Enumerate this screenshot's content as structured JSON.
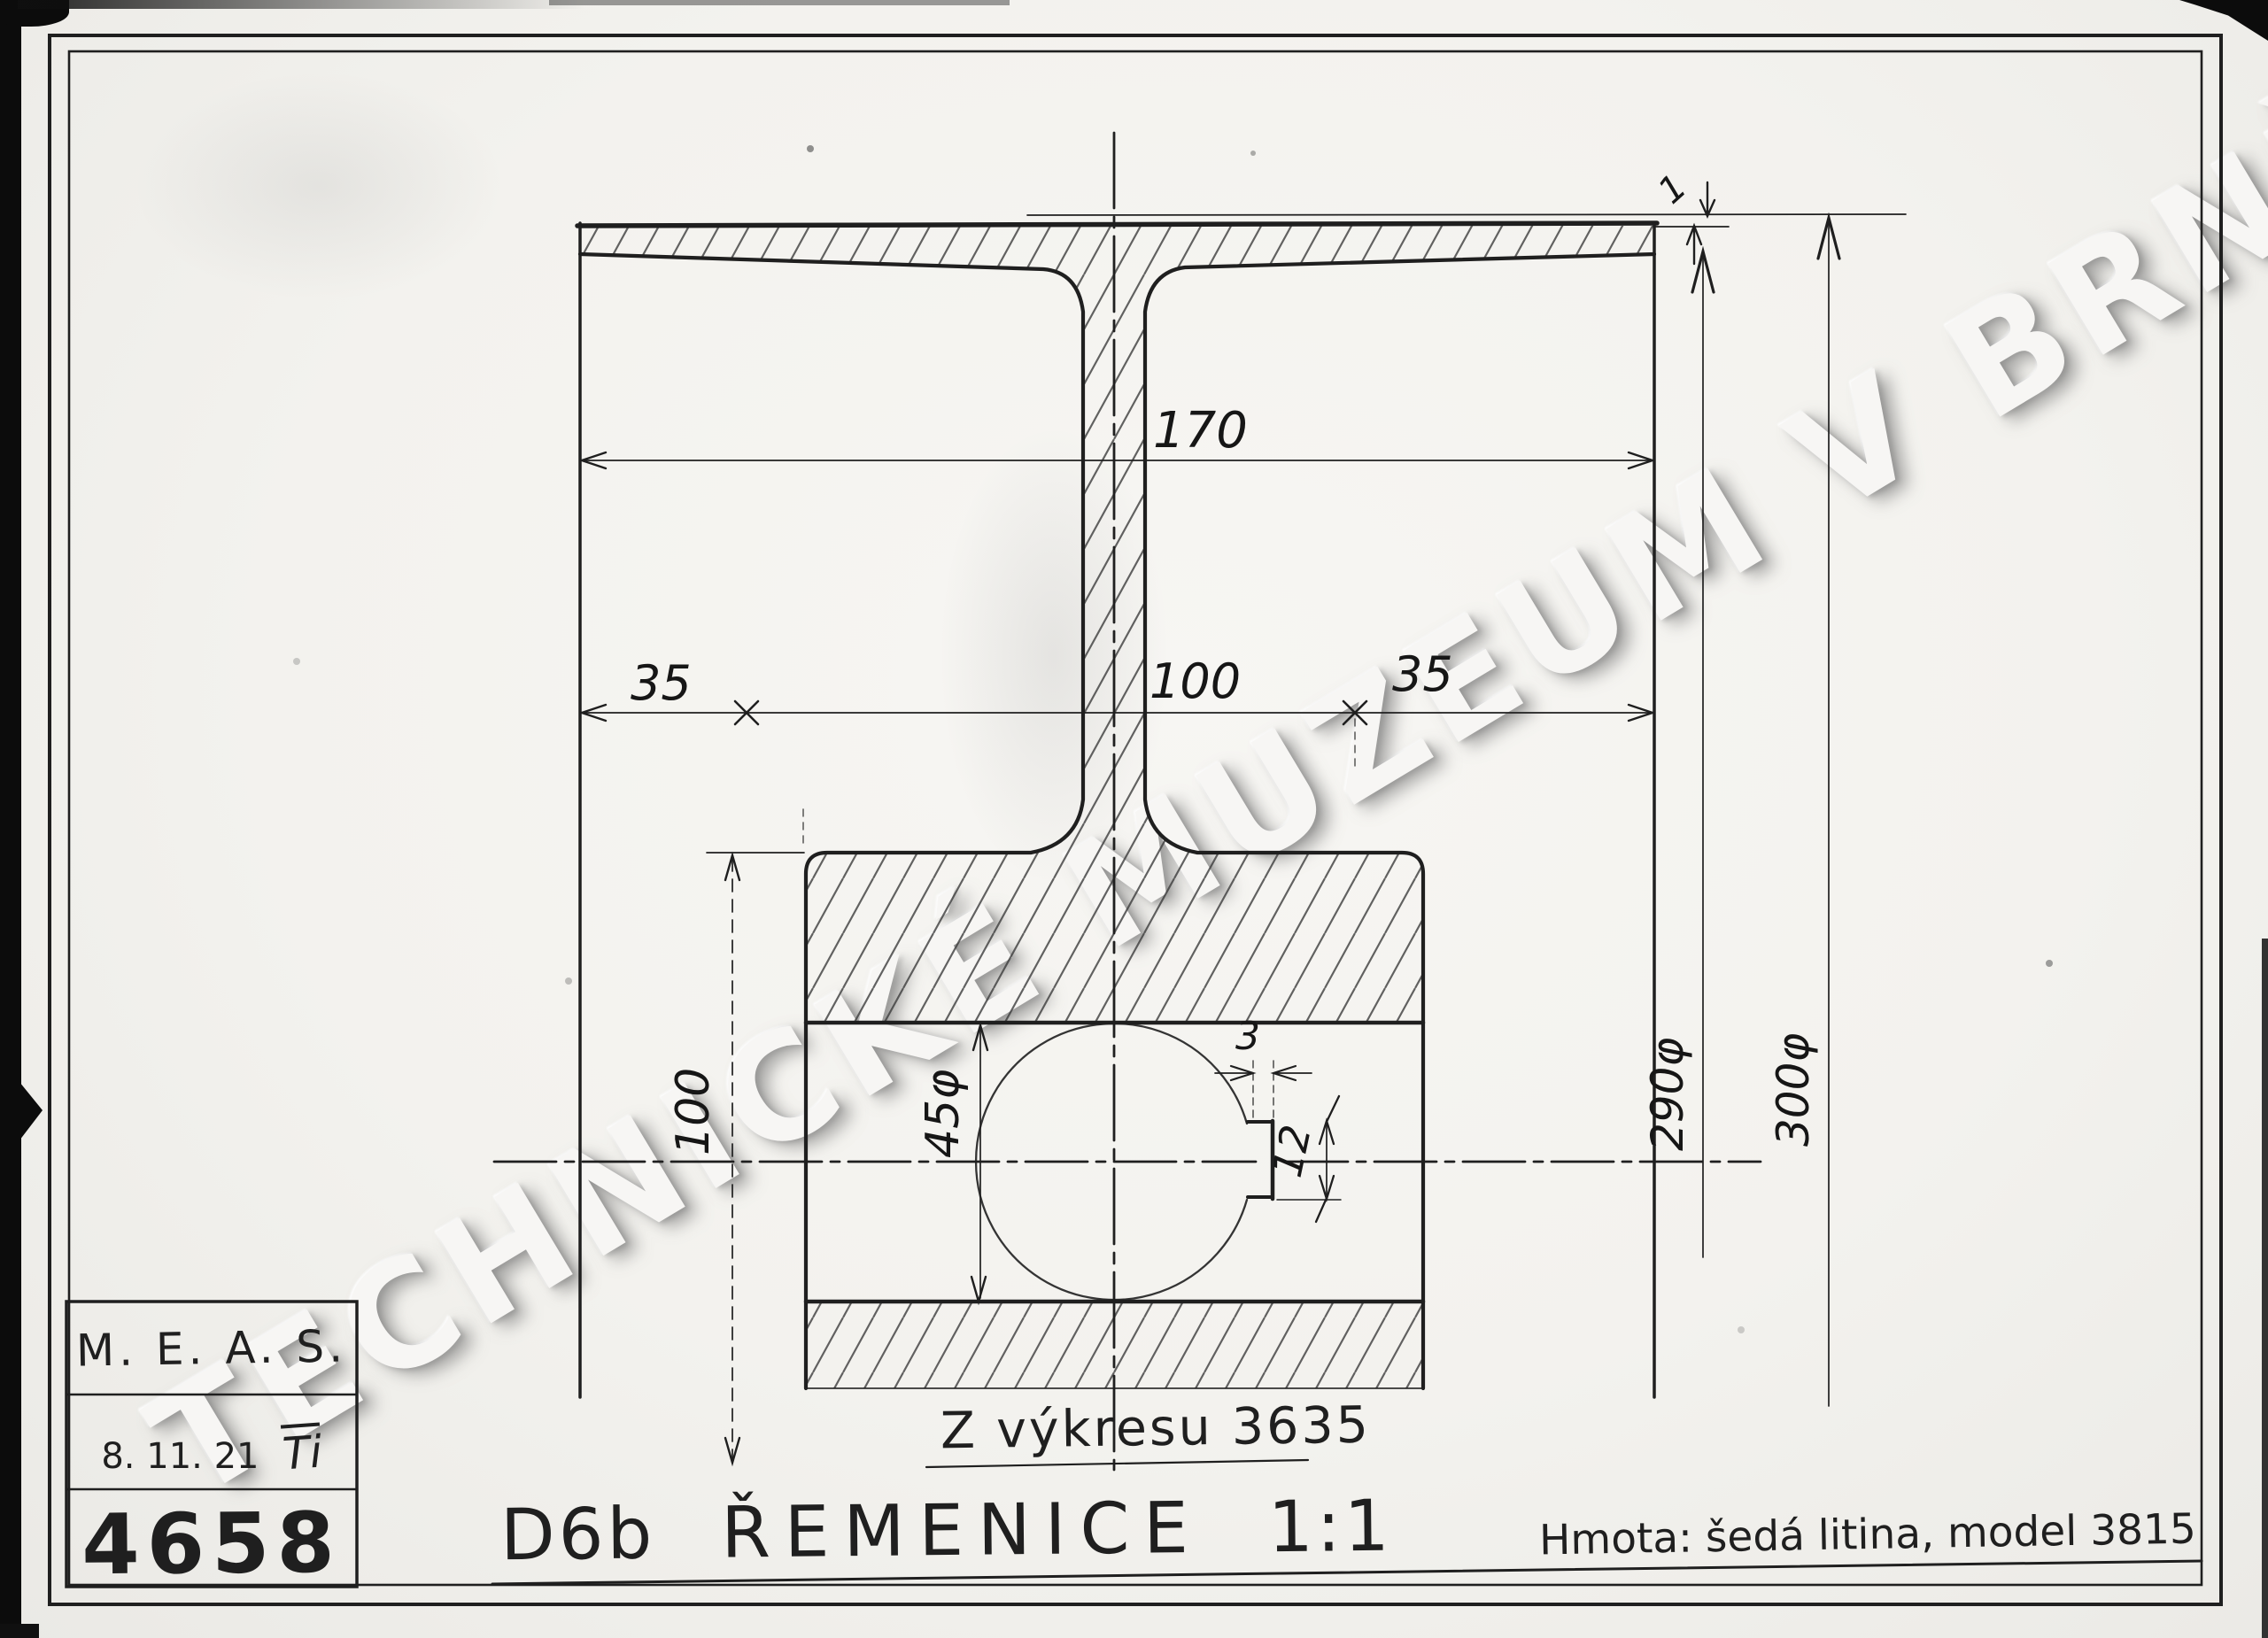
{
  "watermark": {
    "text": "TECHNICKÉ MUZEUM V BRNĚ"
  },
  "title_block": {
    "company": "M. E. A. S.",
    "date": "8. 11. 21",
    "initials": "Ti",
    "drawing_number": "4658"
  },
  "footer": {
    "part_code": "D6b",
    "part_name": "ŘEMENICE",
    "scale": "1:1",
    "material_note": "Hmota: šedá litina, model 3815"
  },
  "note": {
    "reference": "Z výkresu 3635"
  },
  "dims": {
    "rim_width": "170",
    "left_offset": "35",
    "center_width": "100",
    "right_offset": "35",
    "hub_diameter": "100",
    "bore_diameter": "45φ",
    "keyway_width": "3",
    "keyway_depth": "12",
    "inner_diameter": "290φ",
    "outer_diameter": "300φ",
    "crown_height": "1"
  },
  "colors": {
    "paper": "#f3f2ee",
    "ink": "#1f1f1f",
    "watermark": "#f7f6f4"
  }
}
